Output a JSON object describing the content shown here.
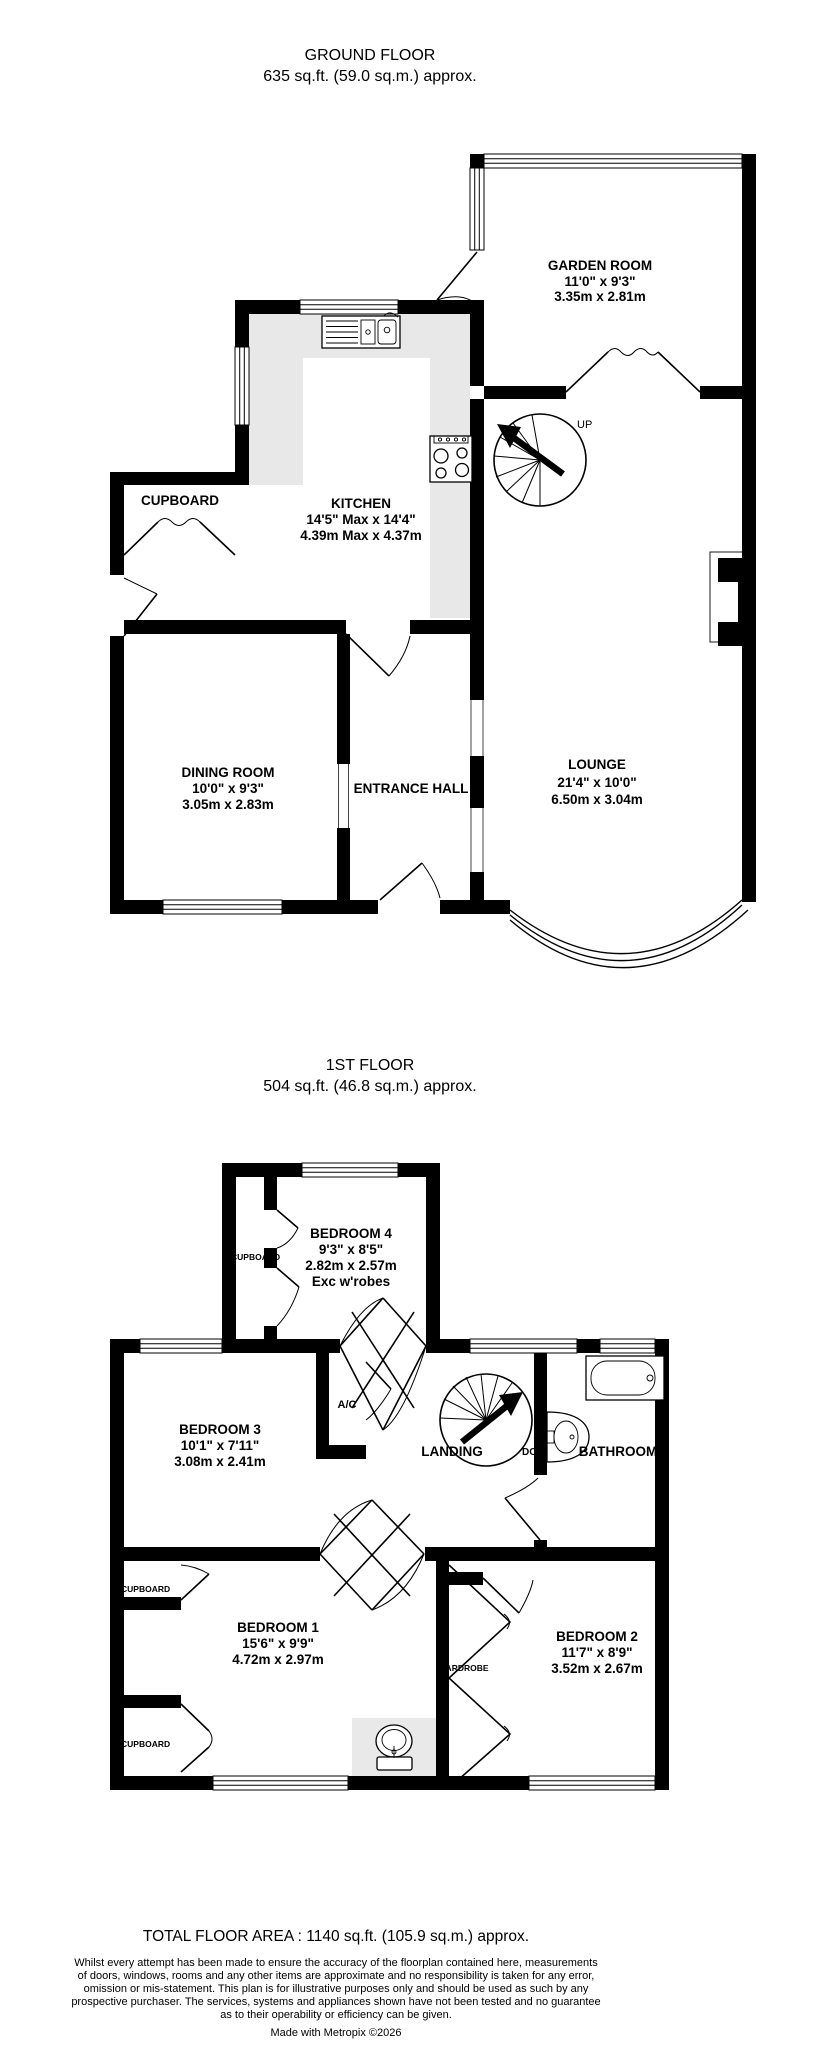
{
  "ground_floor": {
    "title": "GROUND FLOOR",
    "area": "635 sq.ft. (59.0 sq.m.) approx.",
    "rooms": {
      "garden_room": {
        "name": "GARDEN ROOM",
        "imperial": "11'0\"  x 9'3\"",
        "metric": "3.35m  x 2.81m"
      },
      "kitchen": {
        "name": "KITCHEN",
        "imperial": "14'5\" Max x 14'4\"",
        "metric": "4.39m Max x 4.37m"
      },
      "cupboard": {
        "name": "CUPBOARD"
      },
      "dining_room": {
        "name": "DINING ROOM",
        "imperial": "10'0\"  x 9'3\"",
        "metric": "3.05m  x 2.83m"
      },
      "entrance_hall": {
        "name": "ENTRANCE HALL"
      },
      "lounge": {
        "name": "LOUNGE",
        "imperial": "21'4\"  x 10'0\"",
        "metric": "6.50m  x 3.04m"
      }
    },
    "stairs_label": "UP"
  },
  "first_floor": {
    "title": "1ST FLOOR",
    "area": "504 sq.ft. (46.8 sq.m.) approx.",
    "rooms": {
      "bedroom4": {
        "name": "BEDROOM 4",
        "imperial": "9'3\"  x 8'5\"",
        "metric": "2.82m  x 2.57m",
        "note": "Exc w'robes"
      },
      "bedroom3": {
        "name": "BEDROOM 3",
        "imperial": "10'1\"  x 7'11\"",
        "metric": "3.08m  x 2.41m"
      },
      "bedroom1": {
        "name": "BEDROOM 1",
        "imperial": "15'6\"  x 9'9\"",
        "metric": "4.72m  x 2.97m"
      },
      "bedroom2": {
        "name": "BEDROOM 2",
        "imperial": "11'7\"  x 8'9\"",
        "metric": "3.52m  x 2.67m"
      },
      "landing": {
        "name": "LANDING"
      },
      "bathroom": {
        "name": "BATHROOM"
      },
      "ac_closet": {
        "name": "A/C"
      },
      "cupboard_bed4": "CUPBOARD",
      "cupboard_bed1_top": "CUPBOARD",
      "cupboard_bed1_bottom": "CUPBOARD",
      "wardrobe": "WARDROBE"
    },
    "stairs_label": "DOWN"
  },
  "footer": {
    "total_area": "TOTAL FLOOR AREA : 1140 sq.ft. (105.9 sq.m.) approx.",
    "disclaimer_lines": [
      "Whilst every attempt has been made to ensure the accuracy of the floorplan contained here, measurements",
      "of doors, windows, rooms and any other items are approximate and no responsibility is taken for any error,",
      "omission or mis-statement. This plan is for illustrative purposes only and should be used as such by any",
      "prospective purchaser. The services, systems and appliances shown have not been tested and no guarantee",
      "as to their operability or efficiency can be given."
    ],
    "credit": "Made with Metropix ©2026"
  },
  "colors": {
    "wall": "#000000",
    "counter": "#e8e8e8",
    "background": "#ffffff"
  }
}
